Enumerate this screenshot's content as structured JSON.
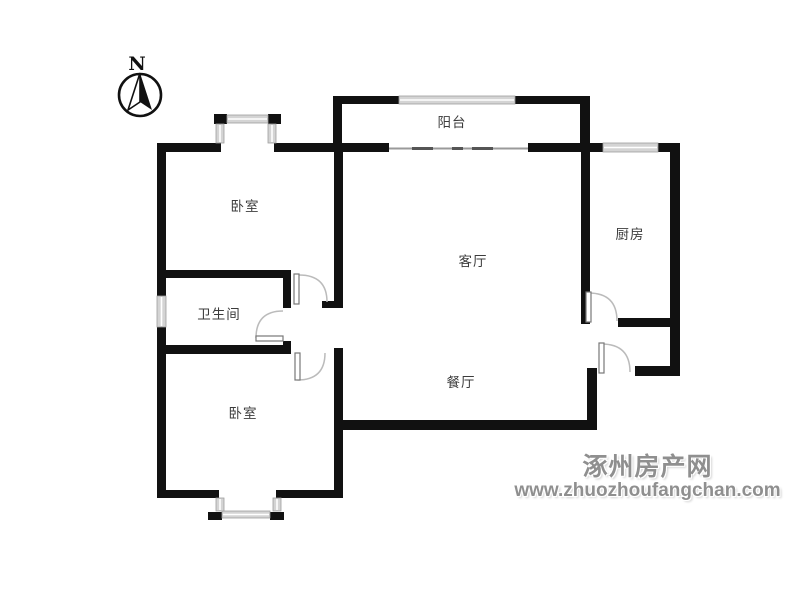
{
  "colors": {
    "background": "#ffffff",
    "wall": "#111111",
    "window_fill": "#d4d4d4",
    "door_arc": "#bbbbbb",
    "room_label": "#3c3c3c",
    "watermark": "#8f8f8f"
  },
  "compass": {
    "label": "N"
  },
  "rooms": [
    {
      "name": "balcony",
      "label": "阳台"
    },
    {
      "name": "bedroom-top",
      "label": "卧室"
    },
    {
      "name": "kitchen",
      "label": "厨房"
    },
    {
      "name": "living-room",
      "label": "客厅"
    },
    {
      "name": "bathroom",
      "label": "卫生间"
    },
    {
      "name": "dining-room",
      "label": "餐厅"
    },
    {
      "name": "bedroom-bottom",
      "label": "卧室"
    }
  ],
  "watermark": {
    "site_name": "涿州房产网",
    "site_url": "www.zhuozhoufangchan.com"
  }
}
